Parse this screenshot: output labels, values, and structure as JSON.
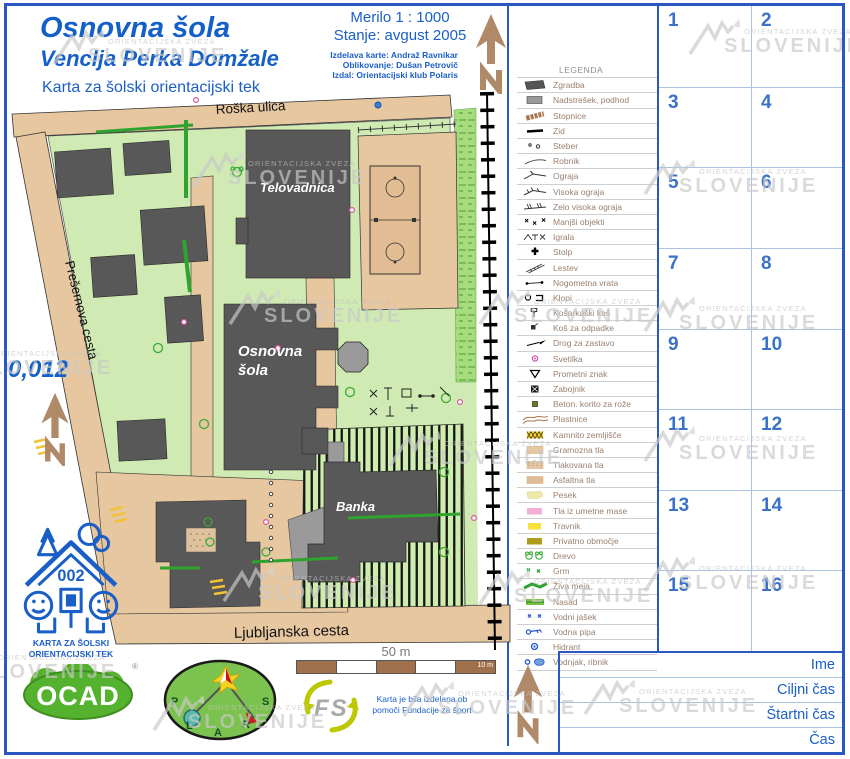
{
  "header": {
    "title1": "Osnovna šola",
    "title2": "Venclja Perka Domžale",
    "subtitle": "Karta za šolski orientacijski tek",
    "scale": "Merilo 1 : 1000",
    "status": "Stanje: avgust 2005",
    "credits": [
      "Izdelava karte: Andraž Ravnikar",
      "Oblikovanje: Dušan Petrovič",
      "Izdal: Orientacijski klub Polaris"
    ]
  },
  "watermark": {
    "line1": "ORIENTACIJSKA ZVEZA",
    "line2": "SLOVENIJE"
  },
  "map": {
    "streets": {
      "top": "Roška ulica",
      "left": "Prešernova cesta",
      "bottom": "Ljubljanska cesta"
    },
    "buildings": {
      "gym": "Telovadnica",
      "school_line1": "Osnovna",
      "school_line2": "šola",
      "bank": "Banka"
    },
    "note": "0,012",
    "scale_bar": {
      "label": "50 m",
      "sub": "10 m"
    }
  },
  "legend": {
    "title": "LEGENDA",
    "items": [
      {
        "icon": "building-icon",
        "label": "Zgradba"
      },
      {
        "icon": "canopy-icon",
        "label": "Nadstrešek, podhod"
      },
      {
        "icon": "stairs-icon",
        "label": "Stopnice"
      },
      {
        "icon": "wall-icon",
        "label": "Zid"
      },
      {
        "icon": "pillar-icon",
        "label": "Steber"
      },
      {
        "icon": "curb-icon",
        "label": "Robnik"
      },
      {
        "icon": "fence-icon",
        "label": "Ograja"
      },
      {
        "icon": "high-fence-icon",
        "label": "Visoka ograja"
      },
      {
        "icon": "very-high-fence-icon",
        "label": "Zelo visoka ograja"
      },
      {
        "icon": "small-objects-icon",
        "label": "Manjši objekti"
      },
      {
        "icon": "playground-icon",
        "label": "Igrala"
      },
      {
        "icon": "tower-icon",
        "label": "Stolp"
      },
      {
        "icon": "ladder-icon",
        "label": "Lestev"
      },
      {
        "icon": "goal-icon",
        "label": "Nogometna vrata"
      },
      {
        "icon": "bench-icon",
        "label": "Klopi"
      },
      {
        "icon": "basketball-hoop-icon",
        "label": "Košarkaški koš"
      },
      {
        "icon": "trash-bin-icon",
        "label": "Koš za odpadke"
      },
      {
        "icon": "flagpole-icon",
        "label": "Drog za zastavo"
      },
      {
        "icon": "lamp-icon",
        "label": "Svetilka"
      },
      {
        "icon": "traffic-sign-icon",
        "label": "Prometni znak"
      },
      {
        "icon": "container-icon",
        "label": "Zabojnik"
      },
      {
        "icon": "flower-box-icon",
        "label": "Beton. korito za rože"
      },
      {
        "icon": "contours-icon",
        "label": "Plastnice"
      },
      {
        "icon": "stony-ground-icon",
        "label": "Kamnito zemljišče"
      },
      {
        "icon": "gravel-icon",
        "label": "Gramozna tla"
      },
      {
        "icon": "paved-icon",
        "label": "Tlakovana tla"
      },
      {
        "icon": "asphalt-icon",
        "label": "Asfaltna tla"
      },
      {
        "icon": "sand-icon",
        "label": "Pesek"
      },
      {
        "icon": "synthetic-icon",
        "label": "Tla iz umetne mase"
      },
      {
        "icon": "meadow-icon",
        "label": "Travnik"
      },
      {
        "icon": "private-icon",
        "label": "Privatno območje"
      },
      {
        "icon": "tree-icon",
        "label": "Drevo"
      },
      {
        "icon": "bush-icon",
        "label": "Grm"
      },
      {
        "icon": "hedge-icon",
        "label": "Živa meja"
      },
      {
        "icon": "plantation-icon",
        "label": "Nasad"
      },
      {
        "icon": "water-shaft-icon",
        "label": "Vodni jašek"
      },
      {
        "icon": "water-tap-icon",
        "label": "Vodna pipa"
      },
      {
        "icon": "hydrant-icon",
        "label": "Hidrant"
      },
      {
        "icon": "pond-icon",
        "label": "Vodnjak, ribnik"
      }
    ]
  },
  "grid": {
    "numbers": [
      "1",
      "2",
      "3",
      "4",
      "5",
      "6",
      "7",
      "8",
      "9",
      "10",
      "11",
      "12",
      "13",
      "14",
      "15",
      "16"
    ]
  },
  "result_table": {
    "rows": [
      "Ime",
      "Ciljni čas",
      "Štartni čas",
      "Čas"
    ]
  },
  "footer": {
    "club_number": "002",
    "club_caption1": "KARTA ZA ŠOLSKI",
    "club_caption2": "ORIENTACIJSKI TEK",
    "ocad": "OCAD",
    "ocad_reg": "®",
    "fs": "FS",
    "funding_line1": "Karta je bila izdelana ob",
    "funding_line2": "pomoči Fundacije za šport"
  },
  "colors": {
    "accent_blue": "#1a5fc8",
    "frame_blue": "#2b57c0",
    "building_dark": "#585858",
    "street_tan": "#e7c7a0",
    "grass_green": "#cfeab2",
    "hedge_green": "#2ea32e",
    "watermark_gray": "#c9c9c9"
  }
}
